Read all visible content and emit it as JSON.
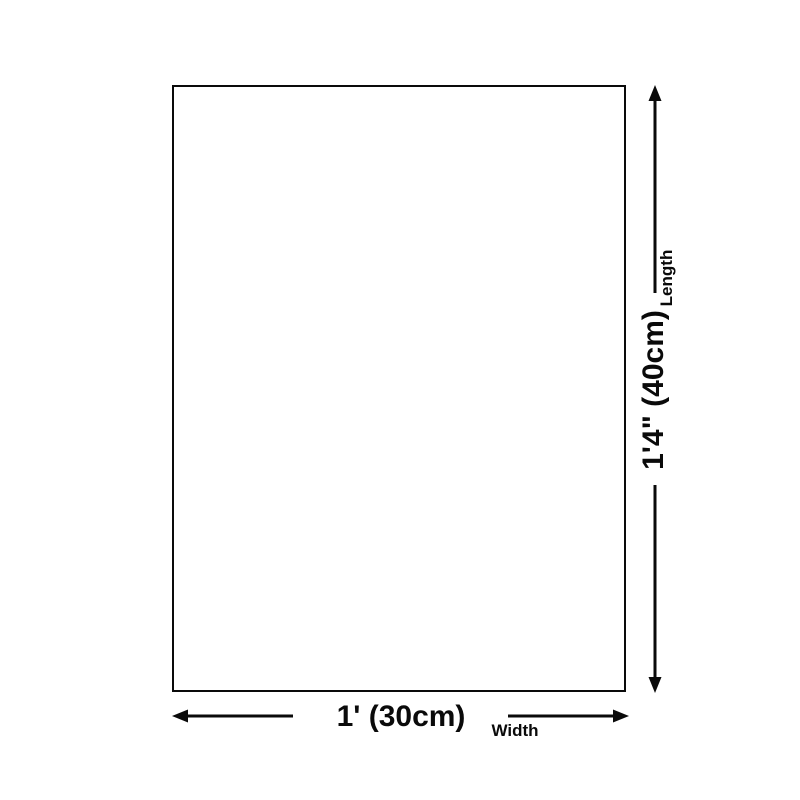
{
  "diagram": {
    "background_color": "#ffffff",
    "line_color": "#0a0a0a",
    "length_annotation": {
      "value": "1'4\" (40cm)",
      "label": "Length"
    },
    "width_annotation": {
      "value": "1' (30cm)",
      "label": "Width"
    }
  }
}
